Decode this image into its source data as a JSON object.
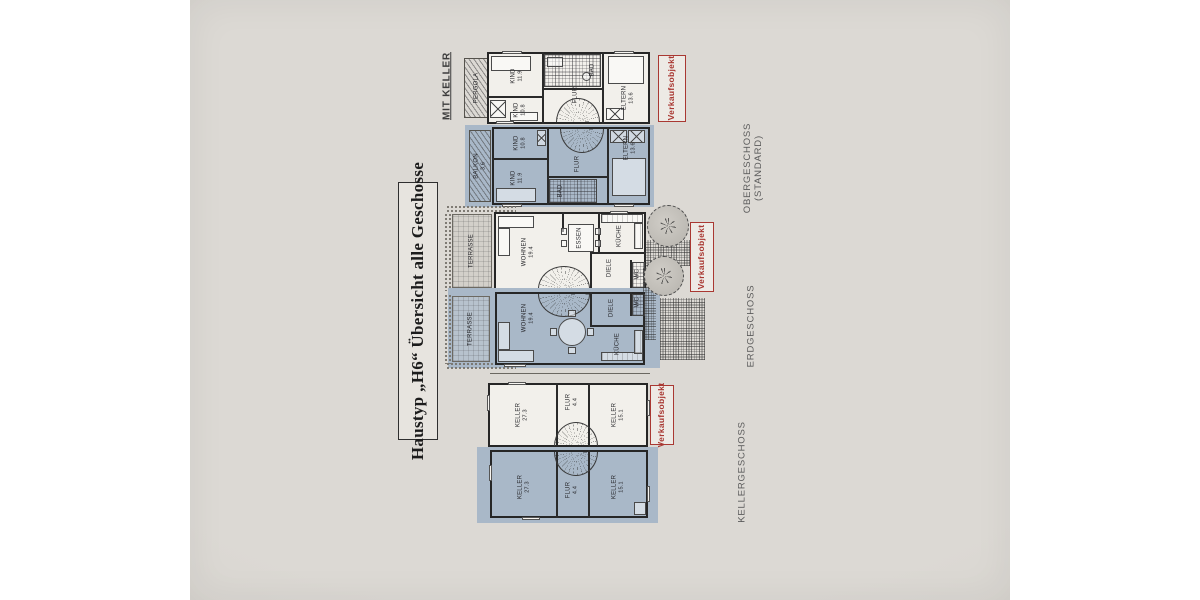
{
  "photo": {
    "title": "Haustyp „H6“ Übersicht alle Geschosse",
    "top_label": "MIT KELLER",
    "sale_tag": "Verkaufsobjekt",
    "floor_labels": {
      "upper": "OBERGESCHOSS",
      "upper_sub": "(STANDARD)",
      "ground": "ERDGESCHOSS",
      "basement": "KELLERGESCHOSS"
    }
  },
  "rooms": {
    "og_std": {
      "kind1": {
        "name": "KIND",
        "area": "11.9"
      },
      "kind2": {
        "name": "KIND",
        "area": "10.8"
      },
      "bad": {
        "name": "BAD"
      },
      "flur": {
        "name": "FLUR"
      },
      "eltern": {
        "name": "ELTERN",
        "area": "13.6"
      },
      "pergola": {
        "name": "PERGOLA"
      }
    },
    "og_sale": {
      "kind1": {
        "name": "KIND",
        "area": "10.8"
      },
      "kind2": {
        "name": "KIND",
        "area": "11.9"
      },
      "bad": {
        "name": "BAD"
      },
      "flur": {
        "name": "FLUR"
      },
      "eltern": {
        "name": "ELTERN",
        "area": "13.6"
      },
      "balkon": {
        "name": "BALKON",
        "area": "3.6"
      }
    },
    "eg_std": {
      "wohnen": {
        "name": "WOHNEN",
        "area": "19.4"
      },
      "essen": {
        "name": "ESSEN"
      },
      "kueche": {
        "name": "KÜCHE"
      },
      "diele": {
        "name": "DIELE"
      },
      "wc": {
        "name": "WC"
      },
      "terrasse": {
        "name": "TERRASSE"
      }
    },
    "eg_sale": {
      "wohnen": {
        "name": "WOHNEN",
        "area": "19.4"
      },
      "kueche": {
        "name": "KÜCHE"
      },
      "diele": {
        "name": "DIELE"
      },
      "wc": {
        "name": "WC"
      },
      "terrasse": {
        "name": "TERRASSE"
      }
    },
    "kg_std": {
      "keller1": {
        "name": "KELLER",
        "area": "27.3"
      },
      "flur": {
        "name": "FLUR",
        "area": "4.4"
      },
      "keller2": {
        "name": "KELLER",
        "area": "15.1"
      }
    },
    "kg_sale": {
      "keller1": {
        "name": "KELLER",
        "area": "27.3"
      },
      "flur": {
        "name": "FLUR",
        "area": "4.4"
      },
      "keller2": {
        "name": "KELLER",
        "area": "15.1"
      }
    }
  },
  "colors": {
    "accent_red": "#a93832",
    "unit_highlight": "#a9b8c8",
    "paper": "#d9d6d1",
    "ink": "#2a2a2a"
  }
}
